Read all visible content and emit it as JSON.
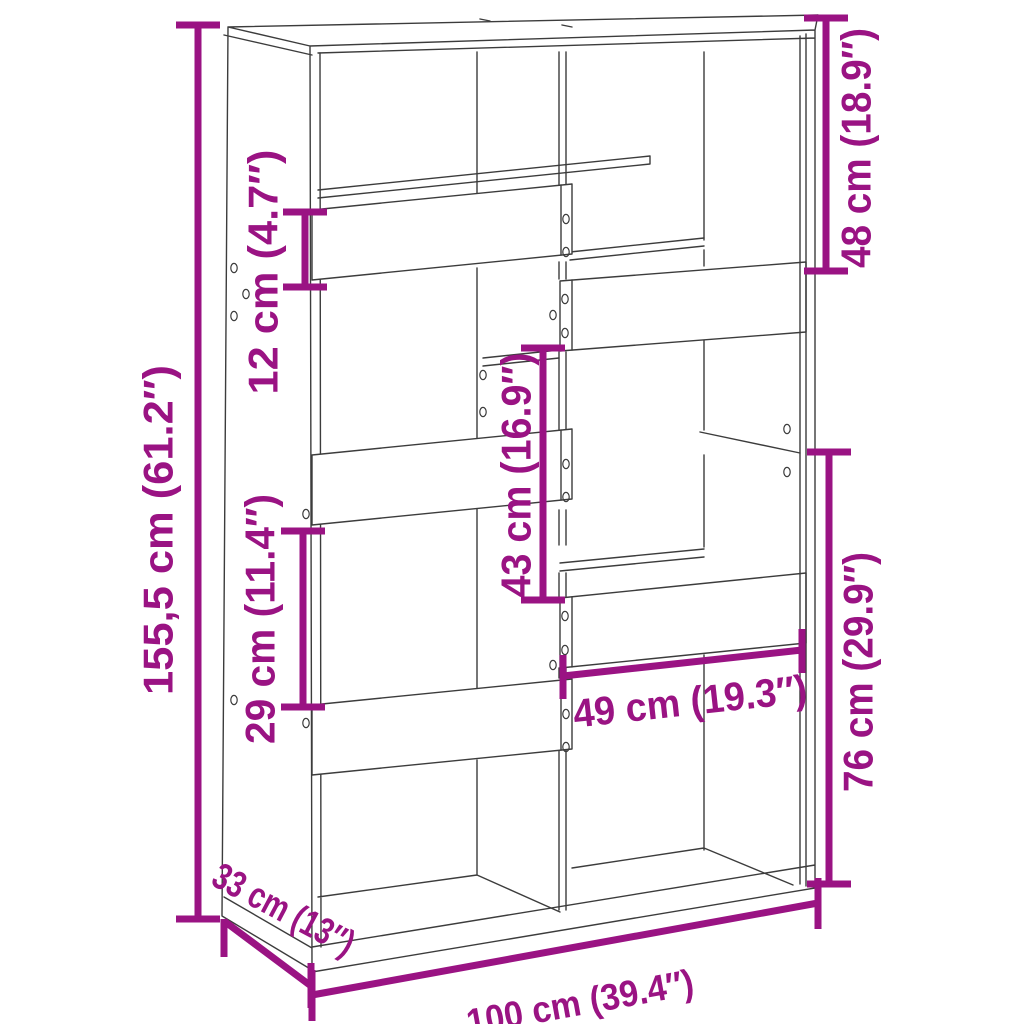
{
  "diagram": {
    "name": "bookcase-room-divider-dimension-diagram",
    "background": "#ffffff",
    "outline_color": "#3c3c3c",
    "dimension_color": "#9a1383",
    "dimensions": {
      "total_height": {
        "label": "155,5 cm (61.2″)",
        "cm": "155,5",
        "inches": "61.2″"
      },
      "board_height": {
        "label": "12 cm (4.7″)",
        "cm": "12",
        "inches": "4.7″"
      },
      "top_right_opening": {
        "label": "48 cm (18.9″)",
        "cm": "48",
        "inches": "18.9″"
      },
      "middle_opening": {
        "label": "43 cm (16.9″)",
        "cm": "43",
        "inches": "16.9″"
      },
      "left_opening": {
        "label": "29 cm (11.4″)",
        "cm": "29",
        "inches": "11.4″"
      },
      "lower_right_opening": {
        "label": "76 cm (29.9″)",
        "cm": "76",
        "inches": "29.9″"
      },
      "opening_width": {
        "label": "49 cm (19.3″)",
        "cm": "49",
        "inches": "19.3″"
      },
      "total_width": {
        "label": "100 cm (39.4″)",
        "cm": "100",
        "inches": "39.4″"
      },
      "total_depth": {
        "label": "33 cm (13″)",
        "cm": "33",
        "inches": "13″"
      }
    }
  }
}
